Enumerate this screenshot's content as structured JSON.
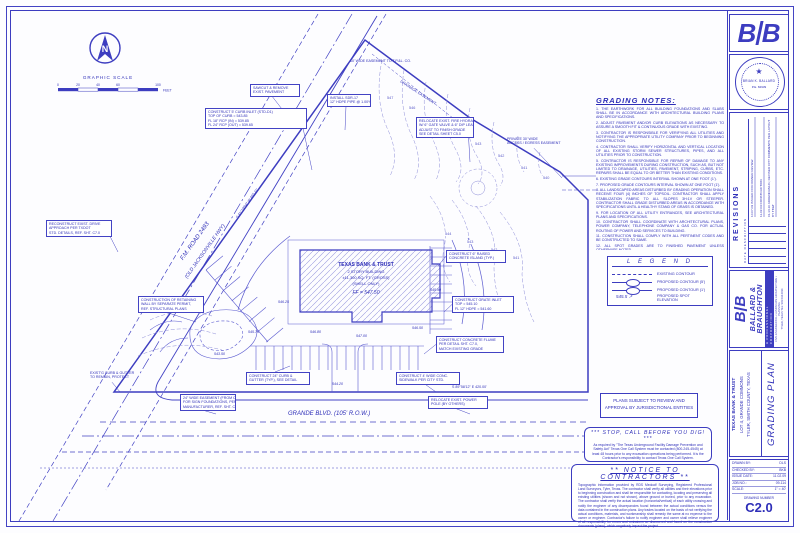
{
  "scalebar": {
    "title": "GRAPHIC SCALE",
    "ticks": [
      "0",
      "20",
      "40",
      "60",
      "100"
    ],
    "unit": "FEET"
  },
  "north_label": "N",
  "plan": {
    "fm_road_label": "F.M. ROAD 2493",
    "fm_road_label2": "(OLD JACKSONVILLE HWY)",
    "grande_label": "GRANDE BLVD.  (105' R.O.W.)",
    "tpl_easement": "10' WIDE EASEMENT TO T.P.&L. CO.",
    "drainage_easement": "DRAINAGE EASEMENT",
    "bearing_fm": "S 41°19'04\" W   465.21'",
    "bearing_grande": "S 89°58'12\" E   420.00'",
    "building": {
      "line1": "TEXAS BANK & TRUST",
      "line2": "2 STORY BUILDING",
      "line3": "±11,300 SQ. FT. (GROSS)",
      "line4": "(SHELL ONLY)",
      "line5": "FF = 547.50"
    }
  },
  "callouts": [
    {
      "x": 205,
      "y": 108,
      "w": 96,
      "t": [
        312,
        170
      ],
      "lines": [
        "CONSTRUCT 5' CURB INLET (STD-D1)",
        "TOP OF CURB = 543.85",
        "FL 18\" RCP (IN) = 539.85",
        "FL 24\" RCP (OUT) = 539.65"
      ]
    },
    {
      "x": 327,
      "y": 94,
      "w": 38,
      "t": [
        345,
        130
      ],
      "lines": [
        "INSTALL SDR-17",
        "12\" HDPE PIPE @ 1.00%"
      ]
    },
    {
      "x": 416,
      "y": 117,
      "w": 52,
      "t": [
        470,
        162
      ],
      "lines": [
        "RELOCATE EXIST. FIRE HYDRANT",
        "W/ 6\" GATE VALVE & 6\" DIP LEAD",
        "ADJUST TO FINISH GRADE",
        "SEE DETAIL SHEET C5.0"
      ]
    },
    {
      "x": 505,
      "y": 136,
      "w": 58,
      "t": [
        562,
        178
      ],
      "nobox": true,
      "lines": [
        "PRIVATE 30' WIDE",
        "ACCESS / EGRESS EASEMENT"
      ]
    },
    {
      "x": 46,
      "y": 220,
      "w": 60,
      "t": [
        118,
        252
      ],
      "lines": [
        "RECONSTRUCT EXIST. DRIVE",
        "APPROACH PER TXDOT",
        "STD. DETAILS, REF. SHT. C7.0"
      ]
    },
    {
      "x": 138,
      "y": 296,
      "w": 60,
      "t": [
        196,
        322
      ],
      "lines": [
        "CONSTRUCTION OF RETAINING",
        "WALL BY SEPARATE PERMIT,",
        "REF. STRUCTURAL PLANS"
      ]
    },
    {
      "x": 446,
      "y": 250,
      "w": 54,
      "t": [
        438,
        266
      ],
      "lines": [
        "CONSTRUCT 6\" RAISED",
        "CONCRETE ISLAND (TYP.)"
      ]
    },
    {
      "x": 452,
      "y": 296,
      "w": 56,
      "t": [
        444,
        312
      ],
      "lines": [
        "CONSTRUCT GRATE INLET",
        "TOP = 545.10",
        "FL 12\" HDPE = 541.60"
      ]
    },
    {
      "x": 436,
      "y": 336,
      "w": 62,
      "t": [
        424,
        354
      ],
      "lines": [
        "CONSTRUCT CONCRETE FLUME",
        "PER DETAIL SHT. C7.0,",
        "MATCH EXISTING GRADE"
      ]
    },
    {
      "x": 246,
      "y": 372,
      "w": 58,
      "t": [
        290,
        366
      ],
      "lines": [
        "CONSTRUCT 24\" CURB &",
        "GUTTER (TYP.), SEE DETAIL"
      ]
    },
    {
      "x": 396,
      "y": 372,
      "w": 58,
      "t": [
        436,
        392
      ],
      "lines": [
        "CONSTRUCT 4' WIDE CONC.",
        "SIDEWALK PER CITY STD."
      ]
    },
    {
      "x": 180,
      "y": 394,
      "w": 50,
      "t": [
        216,
        414
      ],
      "lines": [
        "24\" WIDE EASEMENT (FROM CURB)",
        "FOR SIGN FOUNDATIONS, PER SIGN",
        "MANUFACTURER, REF. SHT. C7.0"
      ]
    },
    {
      "x": 428,
      "y": 396,
      "w": 54,
      "t": [
        470,
        414
      ],
      "lines": [
        "RELOCATE EXIST. POWER",
        "POLE (BY OTHERS)"
      ]
    },
    {
      "x": 88,
      "y": 370,
      "w": 48,
      "t": [
        120,
        392
      ],
      "nobox": true,
      "lines": [
        "EXIST'G CURB & GUTTER",
        "TO REMAIN, PROTECT"
      ]
    },
    {
      "x": 250,
      "y": 84,
      "w": 44,
      "t": [
        292,
        122
      ],
      "lines": [
        "SAWCUT & REMOVE",
        "EXIST. PAVEMENT"
      ]
    }
  ],
  "contour_labels": [
    {
      "x": 386,
      "y": 96,
      "t": "547"
    },
    {
      "x": 408,
      "y": 106,
      "t": "546"
    },
    {
      "x": 430,
      "y": 118,
      "t": "545"
    },
    {
      "x": 452,
      "y": 130,
      "t": "544"
    },
    {
      "x": 474,
      "y": 142,
      "t": "543"
    },
    {
      "x": 497,
      "y": 154,
      "t": "542"
    },
    {
      "x": 520,
      "y": 166,
      "t": "541"
    },
    {
      "x": 542,
      "y": 176,
      "t": "540"
    },
    {
      "x": 444,
      "y": 232,
      "t": "544"
    },
    {
      "x": 466,
      "y": 240,
      "t": "543"
    },
    {
      "x": 490,
      "y": 248,
      "t": "542"
    },
    {
      "x": 512,
      "y": 256,
      "t": "541"
    }
  ],
  "spot_elevations": [
    {
      "x": 310,
      "y": 330,
      "t": "546.80"
    },
    {
      "x": 356,
      "y": 334,
      "t": "547.00"
    },
    {
      "x": 412,
      "y": 326,
      "t": "546.50"
    },
    {
      "x": 278,
      "y": 300,
      "t": "546.25"
    },
    {
      "x": 248,
      "y": 330,
      "t": "545.75"
    },
    {
      "x": 430,
      "y": 288,
      "t": "545.90"
    },
    {
      "x": 332,
      "y": 382,
      "t": "544.20"
    },
    {
      "x": 214,
      "y": 352,
      "t": "543.50"
    }
  ],
  "grading_notes": {
    "title": "GRADING NOTES:",
    "items": [
      "1.   THE EARTHWORK FOR ALL BUILDING FOUNDATIONS AND SLABS SHALL BE IN ACCORDANCE WITH ARCHITECTURAL BUILDING PLANS AND SPECIFICATIONS.",
      "2.   ADJUST PAVEMENT AND/OR CURB ELEVATIONS AS NECESSARY TO ASSURE A SMOOTH FIT & CONTINUOUS GRADE WITH EXISTING.",
      "3.   CONTRACTOR IS RESPONSIBLE FOR VERIFYING ALL UTILITIES AND NOTIFYING THE APPROPRIATE UTILITY COMPANY PRIOR TO BEGINNING CONSTRUCTION.",
      "4.   CONTRACTOR SHALL VERIFY HORIZONTAL AND VERTICAL LOCATION OF ALL EXISTING STORM SEWER STRUCTURES, PIPES, AND ALL UTILITIES PRIOR TO CONSTRUCTION.",
      "5.   CONTRACTOR IS RESPONSIBLE FOR REPAIR OF DAMAGE TO ANY EXISTING IMPROVEMENTS DURING CONSTRUCTION, SUCH AS, BUT NOT LIMITED TO DRAINAGE, UTILITIES, PAVEMENT, STRIPING, CURBS, ETC. REPAIRS SHALL BE EQUAL TO OR BETTER THAN EXISTING CONDITIONS.",
      "6.   EXISTING GRADE CONTOURS INTERVAL SHOWN AT ONE FOOT (1').",
      "7.   PROPOSED GRADE CONTOURS INTERVAL SHOWN AT ONE FOOT (1').",
      "8.   ALL LANDSCAPED AREAS DISTURBED BY GRADING OPERATION SHALL RECEIVE FOUR (4) INCHES OF TOPSOIL. CONTRACTOR SHALL APPLY STABILIZATION FABRIC TO ALL SLOPES 3H:1V OR STEEPER. CONTRACTOR SHALL GRADE DISTURBED AREAS IN ACCORDANCE WITH SPECIFICATIONS UNTIL A HEALTHY STAND OF GRASS IS OBTAINED.",
      "9.   FOR LOCATION OF ALL UTILITY ENTRANCES, SEE ARCHITECTURAL PLANS AND SPECIFICATIONS.",
      "10.  CONTRACTOR SHALL COORDINATE WITH ARCHITECTURAL PLANS, POWER COMPANY, TELEPHONE COMPANY & GAS CO. FOR ACTUAL ROUTING OF POWER AND SERVICES TO BUILDING.",
      "11.  CONSTRUCTION SHALL COMPLY WITH ALL PERTINENT CODES AND BE CONSTRUCTED TO SAME.",
      "12.  ALL SPOT GRADES ARE TO FINISHED PAVEMENT UNLESS OTHERWISE NOTED."
    ]
  },
  "legend": {
    "title": "L E G E N D",
    "rows": [
      {
        "label": "EXISTING CONTOUR"
      },
      {
        "label": "PROPOSED CONTOUR (5')"
      },
      {
        "label": "PROPOSED CONTOUR (1')"
      },
      {
        "label": "PROPOSED SPOT ELEVATION"
      }
    ],
    "spot_symbol": "545.5 ↗"
  },
  "boxes": {
    "plans_subject_line1": "PLANS SUBJECT TO REVIEW AND",
    "plans_subject_line2": "APPROVAL BY JURISDICTIONAL ENTITIES",
    "stop_call_title": "***   STOP, CALL BEFORE YOU DIG!   ***",
    "stop_call_body": "As required by \"The Texas Underground Facility Damage Prevention and Safety Act\" Texas One Call System must be contacted (800-245-4545) at least 48 hours prior to any excavation operations being performed. It is the Contractor's responsibility to contact Texas One Call System.",
    "notice_title": "**   NOTICE  TO  CONTRACTORS   **",
    "notice_body": "Topographic information provided by RDS Medcalf Surveying, Registered Professional Land Surveyors, Tyler, Texas. The contractor shall verify all utilities and their elevations prior to beginning construction and shall be responsible for contacting, locating and preserving all existing utilities (shown and not shown), above ground or buried, prior to any excavation. The contractor shall verify the actual location (horizontal/vertical) of each utility crossing and notify the engineer of any discrepancies found between the actual conditions versus the data contained in the construction plans. Any trades located on the basis of not verifying the actual conditions, materials, and workmanship shall remedy the same at no expense to the owner or engineer. Contractor's failure to notify engineer and owner shall relieve engineer of all responsibility for errors and omissions so discovered and found on the construction documents (plans), which negatively impact the project."
  },
  "titleblock": {
    "seal": {
      "name": "BRIAN K. BALLARD",
      "number": "P.E.  84939"
    },
    "revisions": {
      "title": "REVISIONS",
      "cols": "DATE        DESCRIPTION",
      "entries": [
        "10.07.09   ISSUED FOR OWNER REVIEW",
        "11.02.09   CONSTRUCTION",
        "01.13.10   ADDENDUM #1; REVISED CITY COMMENTS PER LAYOUT BY TB&T"
      ]
    },
    "firm": {
      "name1": "BALLARD &",
      "name2": "BRAUGHTON",
      "tagline": "A PROFESSIONAL CORPORATION",
      "services": "CIVIL ENGINEERING • LANDSCAPE ARCHITECTURE • PLANNING",
      "address": "TYLER, TEXAS      TEL: 903.534.0034"
    },
    "project": {
      "line1": "TEXAS BANK & TRUST",
      "line2": "LOT 4, GRANDE COMMONS",
      "line3": "TYLER, SMITH COUNTY, TEXAS",
      "sheet_title": "GRADING PLAN"
    },
    "info": {
      "rows": [
        [
          "DRAWN BY:",
          "DLS"
        ],
        [
          "CHECKED BY:",
          "BKB"
        ],
        [
          "ISSUE DATE:",
          "11.02.09"
        ],
        [
          "JOB NO.:",
          "09-114"
        ],
        [
          "SCALE:",
          "1\" = 40'"
        ]
      ],
      "number_label": "DRAWING NUMBER",
      "number": "C2.0"
    }
  }
}
